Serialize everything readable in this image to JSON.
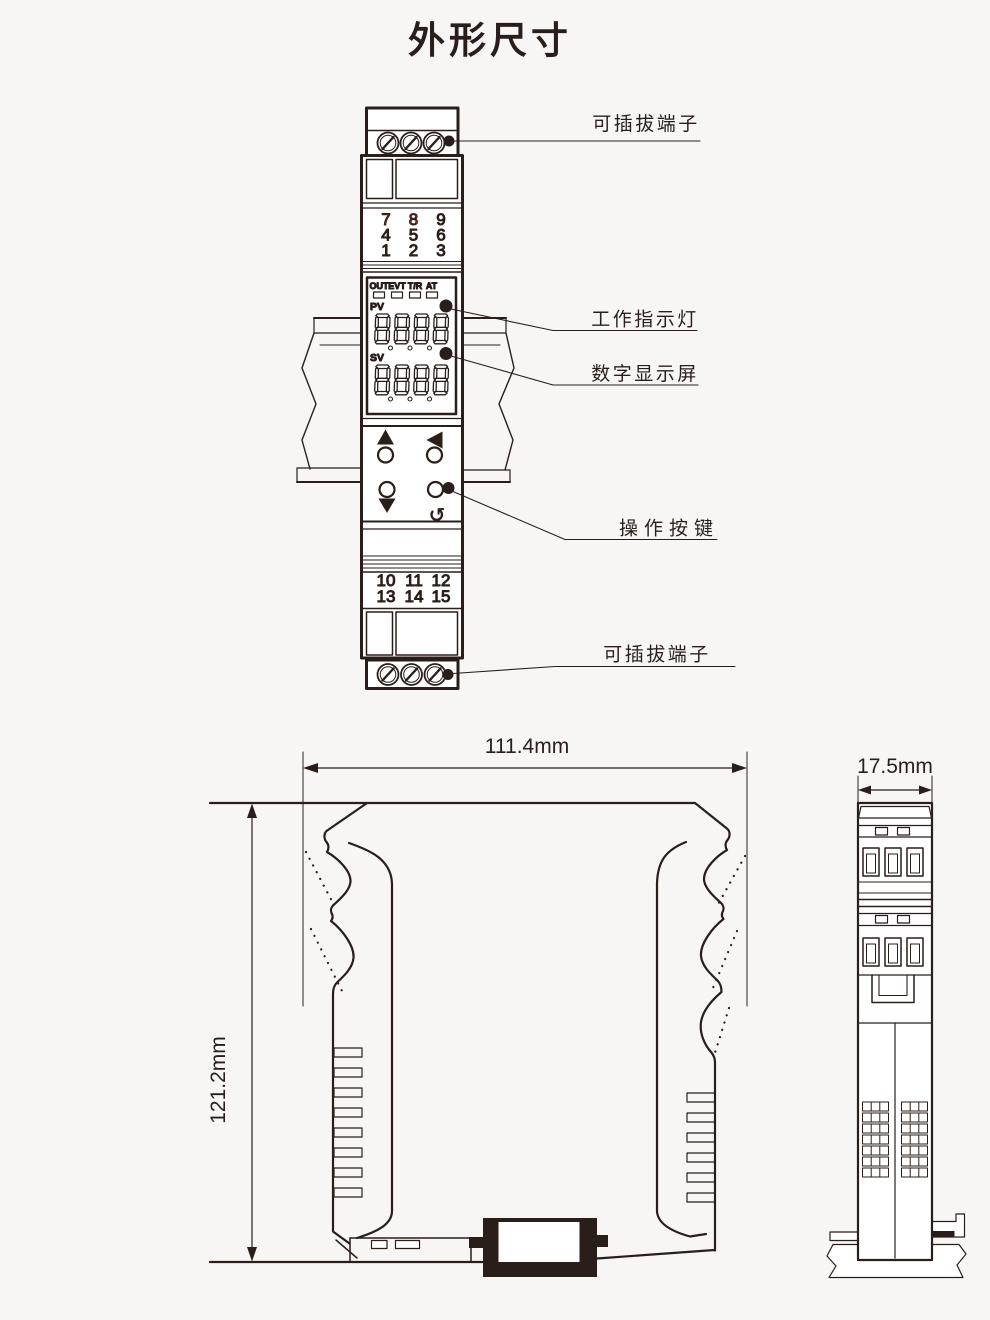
{
  "title": "外形尺寸",
  "colors": {
    "ink": "#2a1e1b",
    "red": "#c8252c",
    "background": "#f7f6f4"
  },
  "front_view": {
    "top_terminal_numbers": [
      [
        "7",
        "8",
        "9"
      ],
      [
        "4",
        "5",
        "6"
      ],
      [
        "1",
        "2",
        "3"
      ]
    ],
    "red_numbers": [
      "7",
      "8"
    ],
    "display": {
      "indicators": [
        "OUT",
        "EVT",
        "T/R",
        "AT"
      ],
      "pv_label": "PV",
      "sv_label": "SV",
      "pv_digits": "8888",
      "sv_digits": "8888"
    },
    "buttons": [
      "up",
      "left",
      "down",
      "return"
    ],
    "bottom_terminal_numbers": [
      [
        "10",
        "11",
        "12"
      ],
      [
        "13",
        "14",
        "15"
      ]
    ]
  },
  "callouts": {
    "top_terminal": "可插拔端子",
    "indicator_lights": "工作指示灯",
    "digital_display": "数字显示屏",
    "operation_buttons": "操作按键",
    "bottom_terminal": "可插拔端子"
  },
  "dimensions": {
    "width": "111.4mm",
    "height": "121.2mm",
    "depth": "17.5mm"
  },
  "icons": {
    "return_arrow": "↺"
  }
}
